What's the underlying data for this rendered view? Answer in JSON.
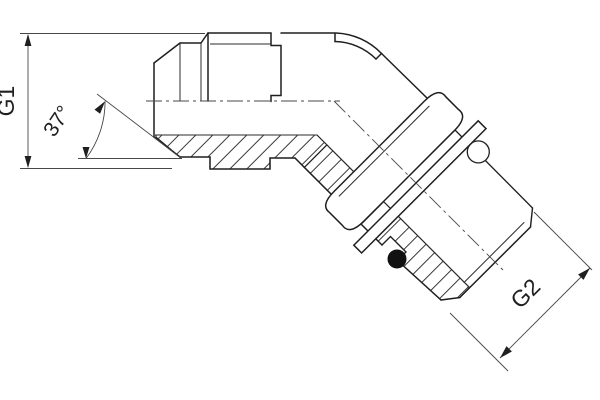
{
  "labels": {
    "g1": "G1",
    "g2": "G2",
    "angle": "37°"
  },
  "colors": {
    "outline": "#1f1f1f",
    "thin_line": "#474747",
    "hatch": "#3a3a3a",
    "o_ring": "#111111",
    "background": "#ffffff"
  }
}
